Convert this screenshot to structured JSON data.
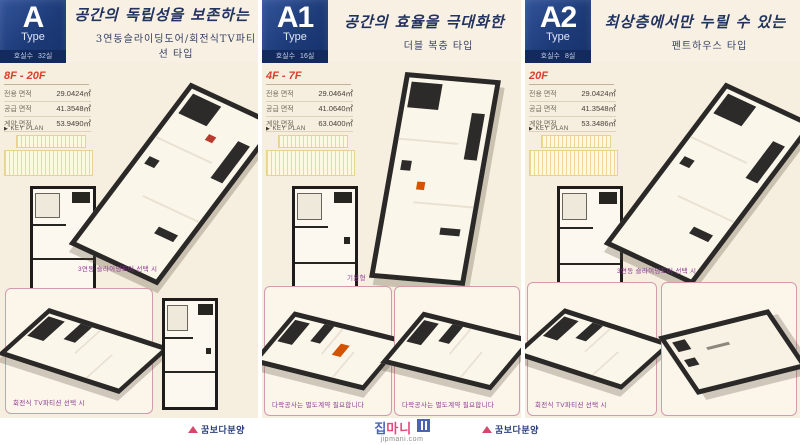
{
  "colors": {
    "background_cream": "#f6eede",
    "badge_navy": "#1d3b78",
    "floors_red": "#d8402f",
    "caption_purple": "#8e3a93",
    "pink_border": "#d49ab0",
    "brand_navy": "#2b3f79",
    "watermark_pink": "#e8467c",
    "watermark_blue": "#4a63b5"
  },
  "footer": {
    "brand": "꿈보다분양",
    "watermark_jip": "집",
    "watermark_mani": "마니",
    "watermark_domain": "jipmani.com"
  },
  "panels": [
    {
      "badge": {
        "letter": "A",
        "type_label": "Type",
        "rooms_label": "호실수",
        "rooms_value": "32실"
      },
      "title": "공간의 독립성을 보존하는",
      "subtitle": "3연동슬라이딩도어/회전식TV파티션 타입",
      "floors": "8F - 20F",
      "areas": [
        {
          "label": "전용 면적",
          "value": "29.0424㎡"
        },
        {
          "label": "공급 면적",
          "value": "41.3548㎡"
        },
        {
          "label": "계약 면적",
          "value": "53.9490㎡"
        }
      ],
      "keyplan_label": "KEY PLAN",
      "main_caption": "3연동 슬라이딩도어 선택 시",
      "bottom_captions": [
        "회전식 TV파티션 선택 시"
      ]
    },
    {
      "badge": {
        "letter": "A1",
        "type_label": "Type",
        "rooms_label": "호실수",
        "rooms_value": "16실"
      },
      "title": "공간의 효율을 극대화한",
      "subtitle": "더블 복층 타입",
      "floors": "4F - 7F",
      "areas": [
        {
          "label": "전용 면적",
          "value": "29.0464㎡"
        },
        {
          "label": "공급 면적",
          "value": "41.0640㎡"
        },
        {
          "label": "계약 면적",
          "value": "63.0400㎡"
        }
      ],
      "keyplan_label": "KEY PLAN",
      "main_caption": "기본형",
      "bottom_captions": [
        "다락공사는 별도계약 필요합니다",
        "다락공사는 별도계약 필요합니다"
      ]
    },
    {
      "badge": {
        "letter": "A2",
        "type_label": "Type",
        "rooms_label": "호실수",
        "rooms_value": "8실"
      },
      "title": "최상층에서만 누릴 수 있는",
      "subtitle": "펜트하우스 타입",
      "floors": "20F",
      "areas": [
        {
          "label": "전용 면적",
          "value": "29.0424㎡"
        },
        {
          "label": "공급 면적",
          "value": "41.3548㎡"
        },
        {
          "label": "계약 면적",
          "value": "53.3486㎡"
        }
      ],
      "keyplan_label": "KEY PLAN",
      "main_caption": "3연동 슬라이딩도어 선택 시",
      "bottom_captions": [
        "회전식 TV파티션 선택 시"
      ]
    }
  ]
}
